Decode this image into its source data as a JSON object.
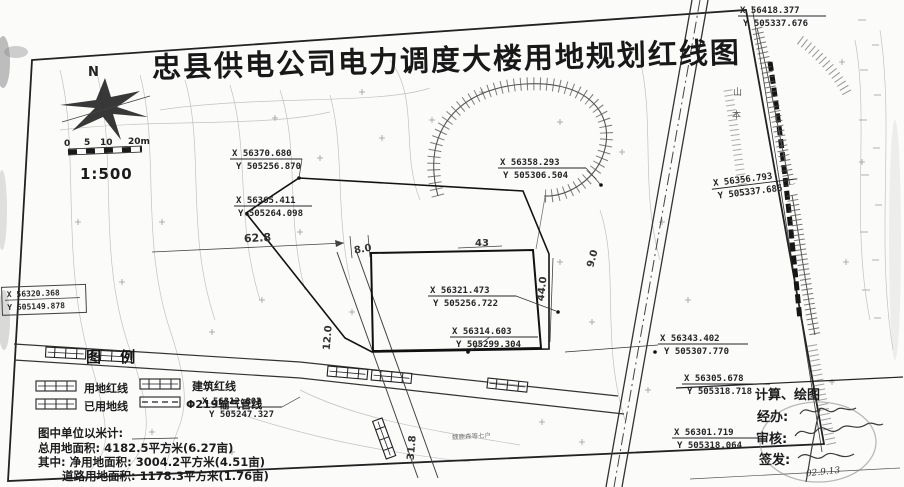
{
  "title": "忠县供电公司电力调度大楼用地规划红线图",
  "compass": {
    "north": "N"
  },
  "scalebar": {
    "ticks": [
      "0",
      "5",
      "10",
      "20m"
    ],
    "ratio": "1:500"
  },
  "points": [
    {
      "x": "X 56370.680",
      "y": "Y 505256.870"
    },
    {
      "x": "X 56365.411",
      "y": "Y 505264.098"
    },
    {
      "x": "X 56358.293",
      "y": "Y 505306.504"
    },
    {
      "x": "X 56321.473",
      "y": "Y 505256.722"
    },
    {
      "x": "X 56314.603",
      "y": "Y 505299.304"
    },
    {
      "x": "X 56418.377",
      "y": "Y 505337.676"
    },
    {
      "x": "X 56356.793",
      "y": "Y 505337.686"
    },
    {
      "x": "X 56343.402",
      "y": "Y 505307.770"
    },
    {
      "x": "X 56305.678",
      "y": "Y 505318.718"
    },
    {
      "x": "X 56301.719",
      "y": "Y 505318.064"
    },
    {
      "x": "X 56312.803",
      "y": "Y 505247.327"
    },
    {
      "x": "X 56320.368",
      "y": "Y 505149.878"
    }
  ],
  "dims": {
    "d62": "62.8",
    "d8": "8.0",
    "d43": "43",
    "d44": "44.0",
    "d31": "31.8",
    "d9": "9.0",
    "d12": "12.0"
  },
  "legend": {
    "header": "图 例",
    "item1": "用地红线",
    "item2": "建筑红线",
    "item3": "已用地线",
    "item4": "Φ219输气管线"
  },
  "stats": {
    "unit": "图中单位以米计:",
    "total": "总用地面积: 4182.5平方米(6.27亩)",
    "net": "其中: 净用地面积: 3004.2平方米(4.51亩)",
    "road": "道路用地面积: 1178.3平方米(1.76亩)"
  },
  "signoff": {
    "calc": "计算、绘图",
    "handle": "经办:",
    "review": "审核:",
    "issue": "签发:",
    "date": "02.9.13"
  },
  "labels": {
    "hill1": "山",
    "hill2": "本",
    "households": "魏鹿森等七户"
  },
  "colors": {
    "ink": "#1c1c1c",
    "faint": "#c2c2c2",
    "paper": "#fbfbfa"
  }
}
